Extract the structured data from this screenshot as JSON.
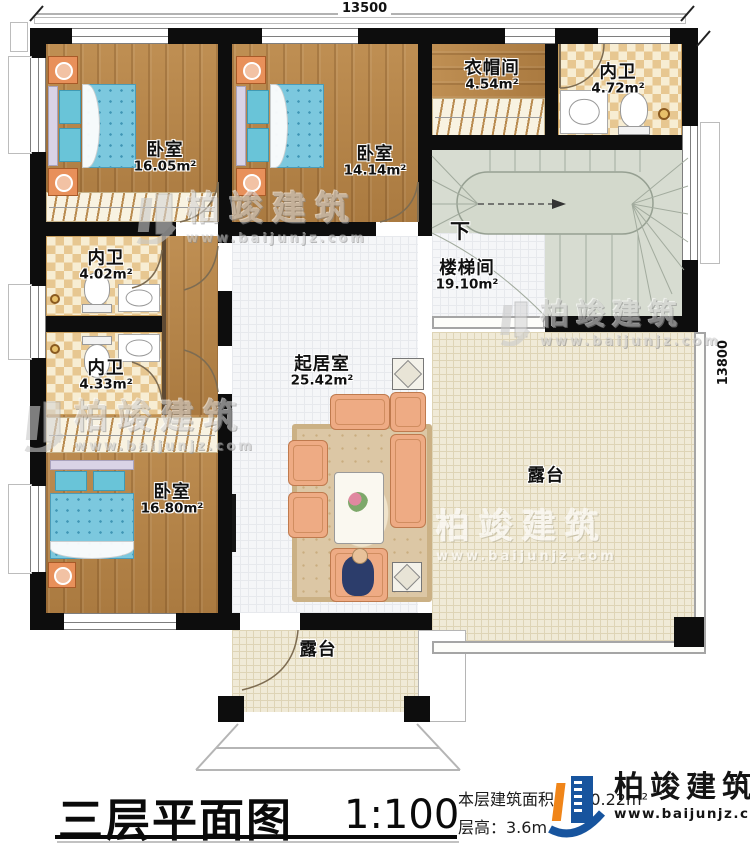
{
  "dimensions": {
    "top": "13500",
    "right": "13800"
  },
  "rooms": {
    "bedroom_top_left": {
      "name": "卧室",
      "area": "16.05m²"
    },
    "bedroom_top_mid": {
      "name": "卧室",
      "area": "14.14m²"
    },
    "cloakroom": {
      "name": "衣帽间",
      "area": "4.54m²"
    },
    "bath_top_right": {
      "name": "内卫",
      "area": "4.72m²"
    },
    "stairwell": {
      "name": "楼梯间",
      "area": "19.10m²",
      "direction": "下"
    },
    "bath_left_upper": {
      "name": "内卫",
      "area": "4.02m²"
    },
    "bath_left_lower": {
      "name": "内卫",
      "area": "4.33m²"
    },
    "bedroom_bottom_left": {
      "name": "卧室",
      "area": "16.80m²"
    },
    "living_room": {
      "name": "起居室",
      "area": "25.42m²"
    },
    "terrace_right": {
      "name": "露台"
    },
    "terrace_bottom": {
      "name": "露台"
    }
  },
  "title_block": {
    "title": "三层平面图",
    "scale": "1:100",
    "floor_area": "本层建筑面积：160.22m²",
    "floor_height": "层高：3.6m"
  },
  "brand": {
    "name": "柏竣建筑",
    "website": "www.baijunjz.com"
  },
  "watermark": {
    "name": "柏竣建筑",
    "website": "www.baijunjz.com"
  },
  "colors": {
    "wall": "#0d0d0d",
    "wood_floor": "#b9894e",
    "bath_tile": "#e7c791",
    "stair_floor": "#d7dcd1",
    "living_tile": "#f5f6f8",
    "terrace": "#f0ead7",
    "bed_blue": "#7cc8de",
    "brand_blue": "#17549e",
    "brand_orange": "#f08519"
  }
}
